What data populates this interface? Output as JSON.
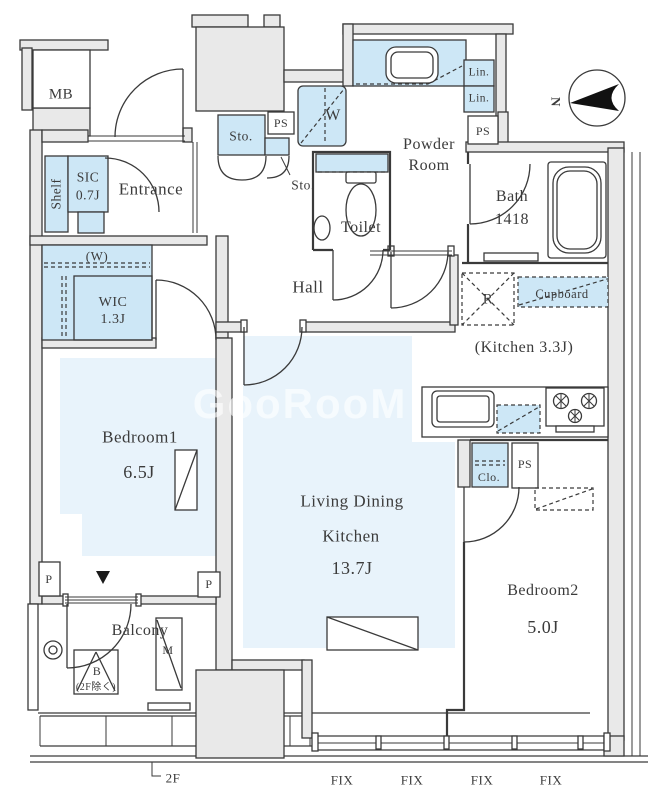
{
  "colors": {
    "background": "#ffffff",
    "wall_fill": "#e9e9e9",
    "fixture_fill": "#cde7f6",
    "floor_tint": "#e8f3fb",
    "line": "#3a3a3a"
  },
  "labels": {
    "mb": "MB",
    "shelf": "Shelf",
    "sic_name": "SIC",
    "sic_size": "0.7J",
    "entrance": "Entrance",
    "w_mark": "(W)",
    "wic_name": "WIC",
    "wic_size": "1.3J",
    "sto_upper": "Sto.",
    "sto_lower": "Sto.",
    "ps_top": "PS",
    "washer": "W",
    "powder_line1": "Powder",
    "powder_line2": "Room",
    "lin_1": "Lin.",
    "lin_2": "Lin.",
    "ps_powder": "PS",
    "bath_name": "Bath",
    "bath_size": "1418",
    "toilet": "Toilet",
    "hall": "Hall",
    "fridge": "R",
    "cupboard": "Cupboard",
    "kitchen_note": "(Kitchen 3.3J)",
    "closet": "Clo.",
    "ps_kitchen": "PS",
    "bedroom1_name": "Bedroom1",
    "bedroom1_size": "6.5J",
    "ldk_line1": "Living Dining",
    "ldk_line2": "Kitchen",
    "ldk_size": "13.7J",
    "bedroom2_name": "Bedroom2",
    "bedroom2_size": "5.0J",
    "balcony": "Balcony",
    "b_mark": "B",
    "b_note": "(2F除く)",
    "m_mark": "M",
    "p_left": "P",
    "p_right": "P",
    "floor_mark": "2F",
    "north": "N",
    "fix": [
      "FIX",
      "FIX",
      "FIX",
      "FIX"
    ]
  },
  "watermark": "GooRooM"
}
